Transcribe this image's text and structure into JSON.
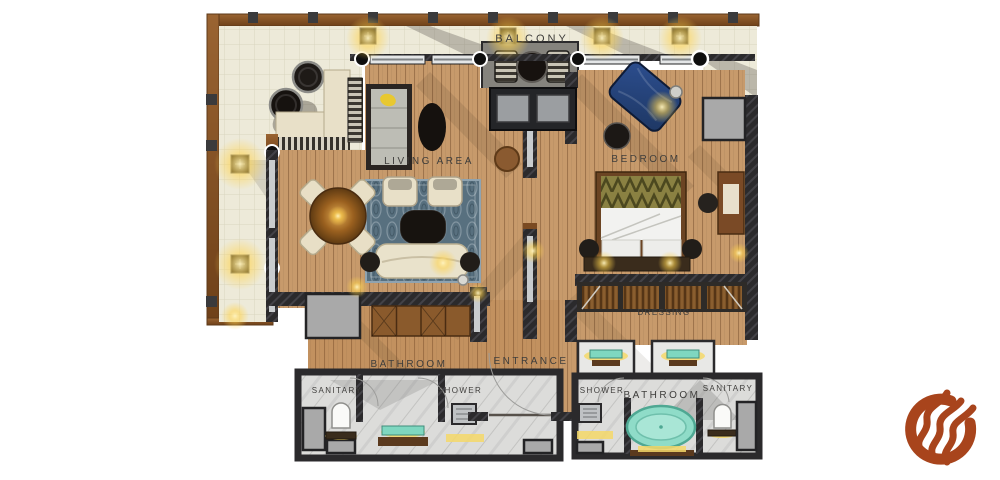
{
  "floorplan": {
    "labels": {
      "balcony": "BALCONY",
      "living_area": "LIVING AREA",
      "bedroom": "BEDROOM",
      "bathroom_left": "BATHROOM",
      "entrance": "ENTRANCE",
      "sanitary_left": "SANITARY",
      "shower_left": "SHOWER",
      "dressing": "DRESSING",
      "shower_right": "SHOWER",
      "bathroom_right": "BATHROOM",
      "sanitary_right": "SANITARY"
    },
    "colors": {
      "wood": "#C79A6B",
      "wood_border": "#8A5A2E",
      "balcony_floor": "#EDEAD9",
      "wall": "#2B2A2C",
      "marble": "#DCDCDA",
      "teal": "#7FD7C0",
      "rug": "#58707F",
      "cream": "#E8E0C8",
      "navy": "#1E3763",
      "glow": "#FFD34D",
      "gray_utility": "#A9A9A9",
      "label": "#3F3E3C",
      "logo": "#A8441C"
    },
    "icons": {
      "logo": "flame-ring-logo"
    }
  }
}
